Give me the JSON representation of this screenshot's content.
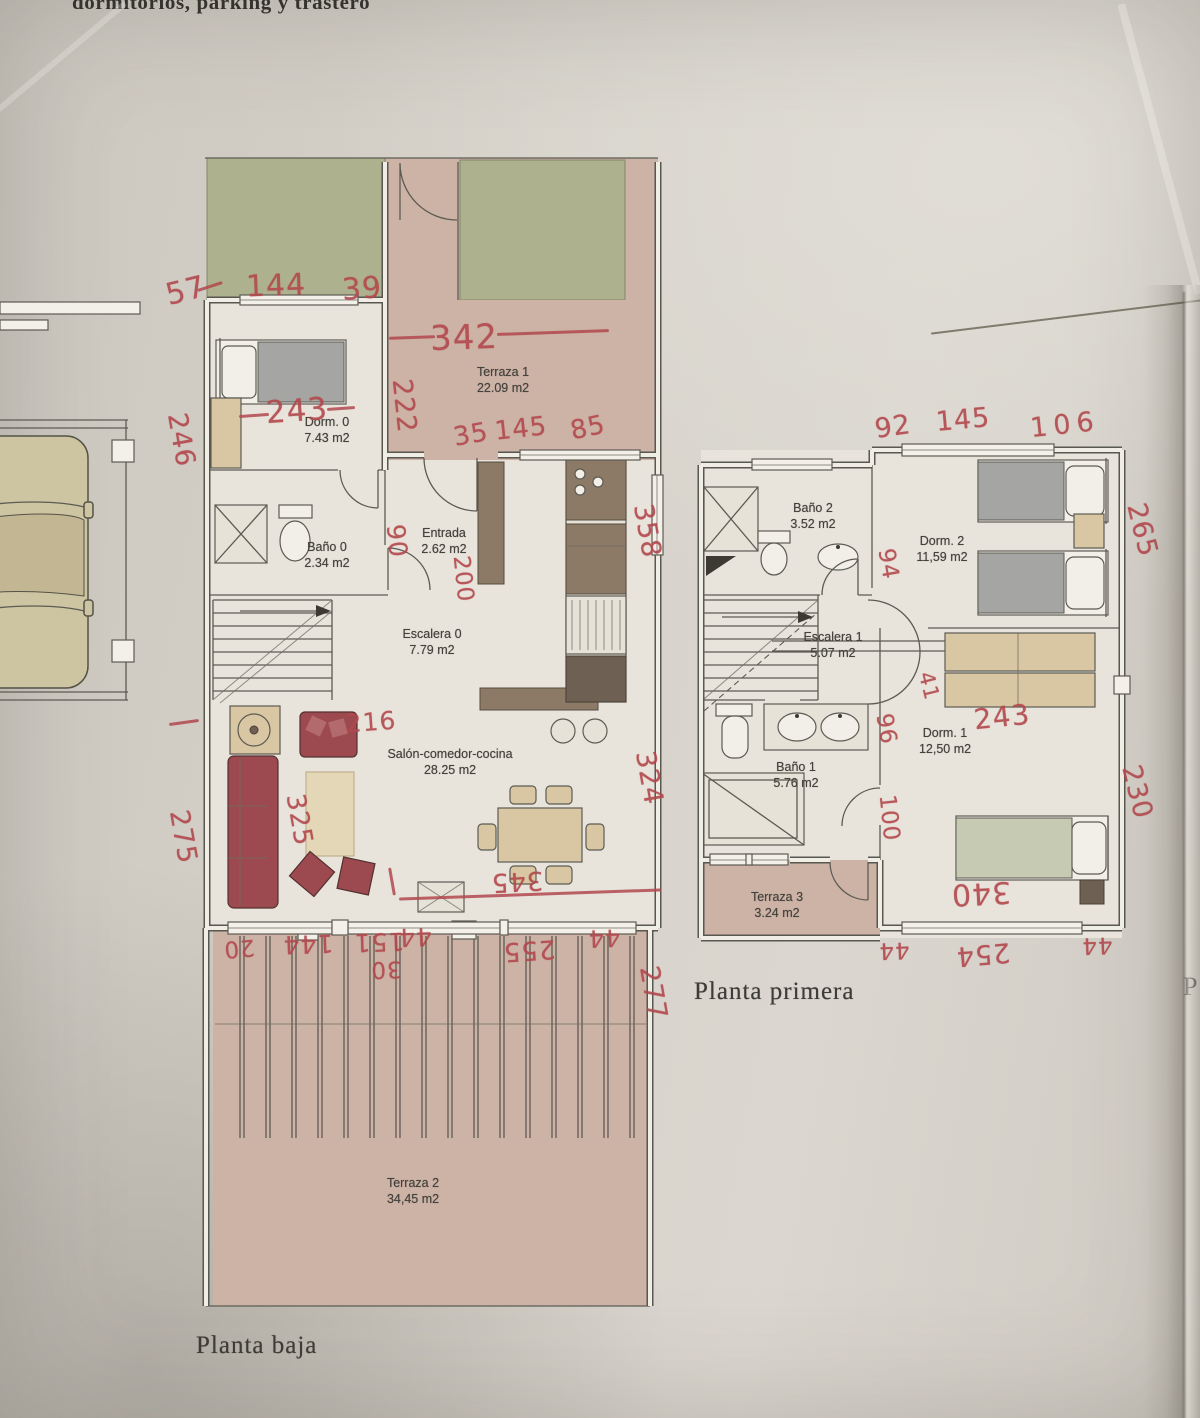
{
  "page": {
    "header_fragment": "dormitorios, parking y trastero",
    "stray_letter": "P"
  },
  "palette": {
    "ink": "#b2484d",
    "paper": "#d4d0c8",
    "floor": "#e8e4dc",
    "terrace": "#cdb2a6",
    "garden": "#adb18d",
    "wood": "#d9c6a2",
    "sofa": "#9c4a50"
  },
  "plans": [
    {
      "caption": "Planta baja",
      "rooms": [
        {
          "name": "Terraza 1",
          "area": "22.09 m2"
        },
        {
          "name": "Dorm. 0",
          "area": "7.43 m2"
        },
        {
          "name": "Baño 0",
          "area": "2.34 m2"
        },
        {
          "name": "Entrada",
          "area": "2.62 m2"
        },
        {
          "name": "Escalera 0",
          "area": "7.79 m2"
        },
        {
          "name": "Salón-comedor-cocina",
          "area": "28.25 m2"
        },
        {
          "name": "Terraza 2",
          "area": "34,45 m2"
        }
      ]
    },
    {
      "caption": "Planta primera",
      "rooms": [
        {
          "name": "Baño 2",
          "area": "3.52 m2"
        },
        {
          "name": "Dorm. 2",
          "area": "11,59 m2"
        },
        {
          "name": "Escalera 1",
          "area": "5.07 m2"
        },
        {
          "name": "Dorm. 1",
          "area": "12,50 m2"
        },
        {
          "name": "Baño 1",
          "area": "5.76 m2"
        },
        {
          "name": "Terraza 3",
          "area": "3.24 m2"
        }
      ]
    }
  ],
  "handwriting": [
    {
      "t": "57",
      "x": 186,
      "y": 291,
      "r": -14,
      "s": 30
    },
    {
      "t": "144",
      "x": 276,
      "y": 286,
      "r": -2,
      "s": 30
    },
    {
      "t": "39",
      "x": 362,
      "y": 289,
      "r": -4,
      "s": 30
    },
    {
      "t": "342",
      "x": 464,
      "y": 338,
      "r": -2,
      "s": 34
    },
    {
      "t": "222",
      "x": 404,
      "y": 406,
      "r": 84,
      "s": 27
    },
    {
      "t": "246",
      "x": 181,
      "y": 440,
      "r": 80,
      "s": 27
    },
    {
      "t": "243",
      "x": 297,
      "y": 411,
      "r": -4,
      "s": 31
    },
    {
      "t": "35",
      "x": 471,
      "y": 435,
      "r": -10,
      "s": 26
    },
    {
      "t": "145",
      "x": 521,
      "y": 429,
      "r": -6,
      "s": 26
    },
    {
      "t": "85",
      "x": 588,
      "y": 428,
      "r": -12,
      "s": 26
    },
    {
      "t": "90",
      "x": 397,
      "y": 541,
      "r": 84,
      "s": 25
    },
    {
      "t": "200",
      "x": 463,
      "y": 579,
      "r": 84,
      "s": 23
    },
    {
      "t": "358",
      "x": 647,
      "y": 531,
      "r": 80,
      "s": 27
    },
    {
      "t": "216",
      "x": 371,
      "y": 722,
      "r": -4,
      "s": 25
    },
    {
      "t": "325",
      "x": 299,
      "y": 820,
      "r": 80,
      "s": 26
    },
    {
      "t": "275",
      "x": 183,
      "y": 837,
      "r": 80,
      "s": 27
    },
    {
      "t": "324",
      "x": 649,
      "y": 778,
      "r": 80,
      "s": 27
    },
    {
      "t": "345",
      "x": 517,
      "y": 881,
      "r": 177,
      "s": 26
    },
    {
      "t": "20",
      "x": 239,
      "y": 948,
      "r": 175,
      "s": 23
    },
    {
      "t": "144",
      "x": 308,
      "y": 944,
      "r": 178,
      "s": 25
    },
    {
      "t": "151",
      "x": 379,
      "y": 942,
      "r": 178,
      "s": 25
    },
    {
      "t": "44",
      "x": 415,
      "y": 937,
      "r": 178,
      "s": 25
    },
    {
      "t": "30",
      "x": 386,
      "y": 969,
      "r": 178,
      "s": 23
    },
    {
      "t": "255",
      "x": 529,
      "y": 950,
      "r": 176,
      "s": 26
    },
    {
      "t": "44",
      "x": 604,
      "y": 938,
      "r": 178,
      "s": 24
    },
    {
      "t": "277",
      "x": 653,
      "y": 993,
      "r": 80,
      "s": 27
    },
    {
      "t": "92",
      "x": 893,
      "y": 427,
      "r": -8,
      "s": 27
    },
    {
      "t": "145",
      "x": 963,
      "y": 420,
      "r": -5,
      "s": 27
    },
    {
      "t": "106",
      "x": 1065,
      "y": 425,
      "r": -6,
      "s": 27,
      "ls": 6
    },
    {
      "t": "265",
      "x": 1142,
      "y": 530,
      "r": 76,
      "s": 27
    },
    {
      "t": "94",
      "x": 888,
      "y": 564,
      "r": 80,
      "s": 23
    },
    {
      "t": "41",
      "x": 929,
      "y": 686,
      "r": 76,
      "s": 21
    },
    {
      "t": "96",
      "x": 886,
      "y": 729,
      "r": 80,
      "s": 23
    },
    {
      "t": "100",
      "x": 889,
      "y": 818,
      "r": 84,
      "s": 23
    },
    {
      "t": "243",
      "x": 1002,
      "y": 717,
      "r": -6,
      "s": 28
    },
    {
      "t": "230",
      "x": 1137,
      "y": 792,
      "r": 76,
      "s": 27
    },
    {
      "t": "340",
      "x": 981,
      "y": 893,
      "r": 177,
      "s": 30
    },
    {
      "t": "44",
      "x": 894,
      "y": 950,
      "r": 178,
      "s": 23
    },
    {
      "t": "254",
      "x": 983,
      "y": 954,
      "r": 175,
      "s": 27
    },
    {
      "t": "44",
      "x": 1097,
      "y": 945,
      "r": 178,
      "s": 23
    }
  ],
  "ink_strokes": [
    {
      "x": 412,
      "y": 336,
      "w": 46,
      "r": -2
    },
    {
      "x": 553,
      "y": 331,
      "w": 112,
      "r": -2
    },
    {
      "x": 254,
      "y": 414,
      "w": 30,
      "r": -4
    },
    {
      "x": 341,
      "y": 407,
      "w": 28,
      "r": -4
    },
    {
      "x": 530,
      "y": 893,
      "w": 262,
      "r": -2
    },
    {
      "x": 392,
      "y": 880,
      "w": 28,
      "r": 80
    },
    {
      "x": 184,
      "y": 721,
      "w": 30,
      "r": -8
    },
    {
      "x": 210,
      "y": 285,
      "w": 26,
      "r": -18
    },
    {
      "x": 1066,
      "y": 316,
      "w": 272,
      "r": -7,
      "c": "#6f6a5a",
      "h": 2
    },
    {
      "x": 1184,
      "y": 855,
      "w": 1130,
      "r": 90,
      "c": "rgba(75,70,58,0.5)",
      "h": 3
    },
    {
      "x": 1160,
      "y": 145,
      "w": 300,
      "r": 75,
      "c": "rgba(250,248,242,0.35)",
      "h": 8
    },
    {
      "x": 60,
      "y": 55,
      "w": 170,
      "r": -40,
      "c": "rgba(250,248,242,0.3)",
      "h": 6
    }
  ]
}
